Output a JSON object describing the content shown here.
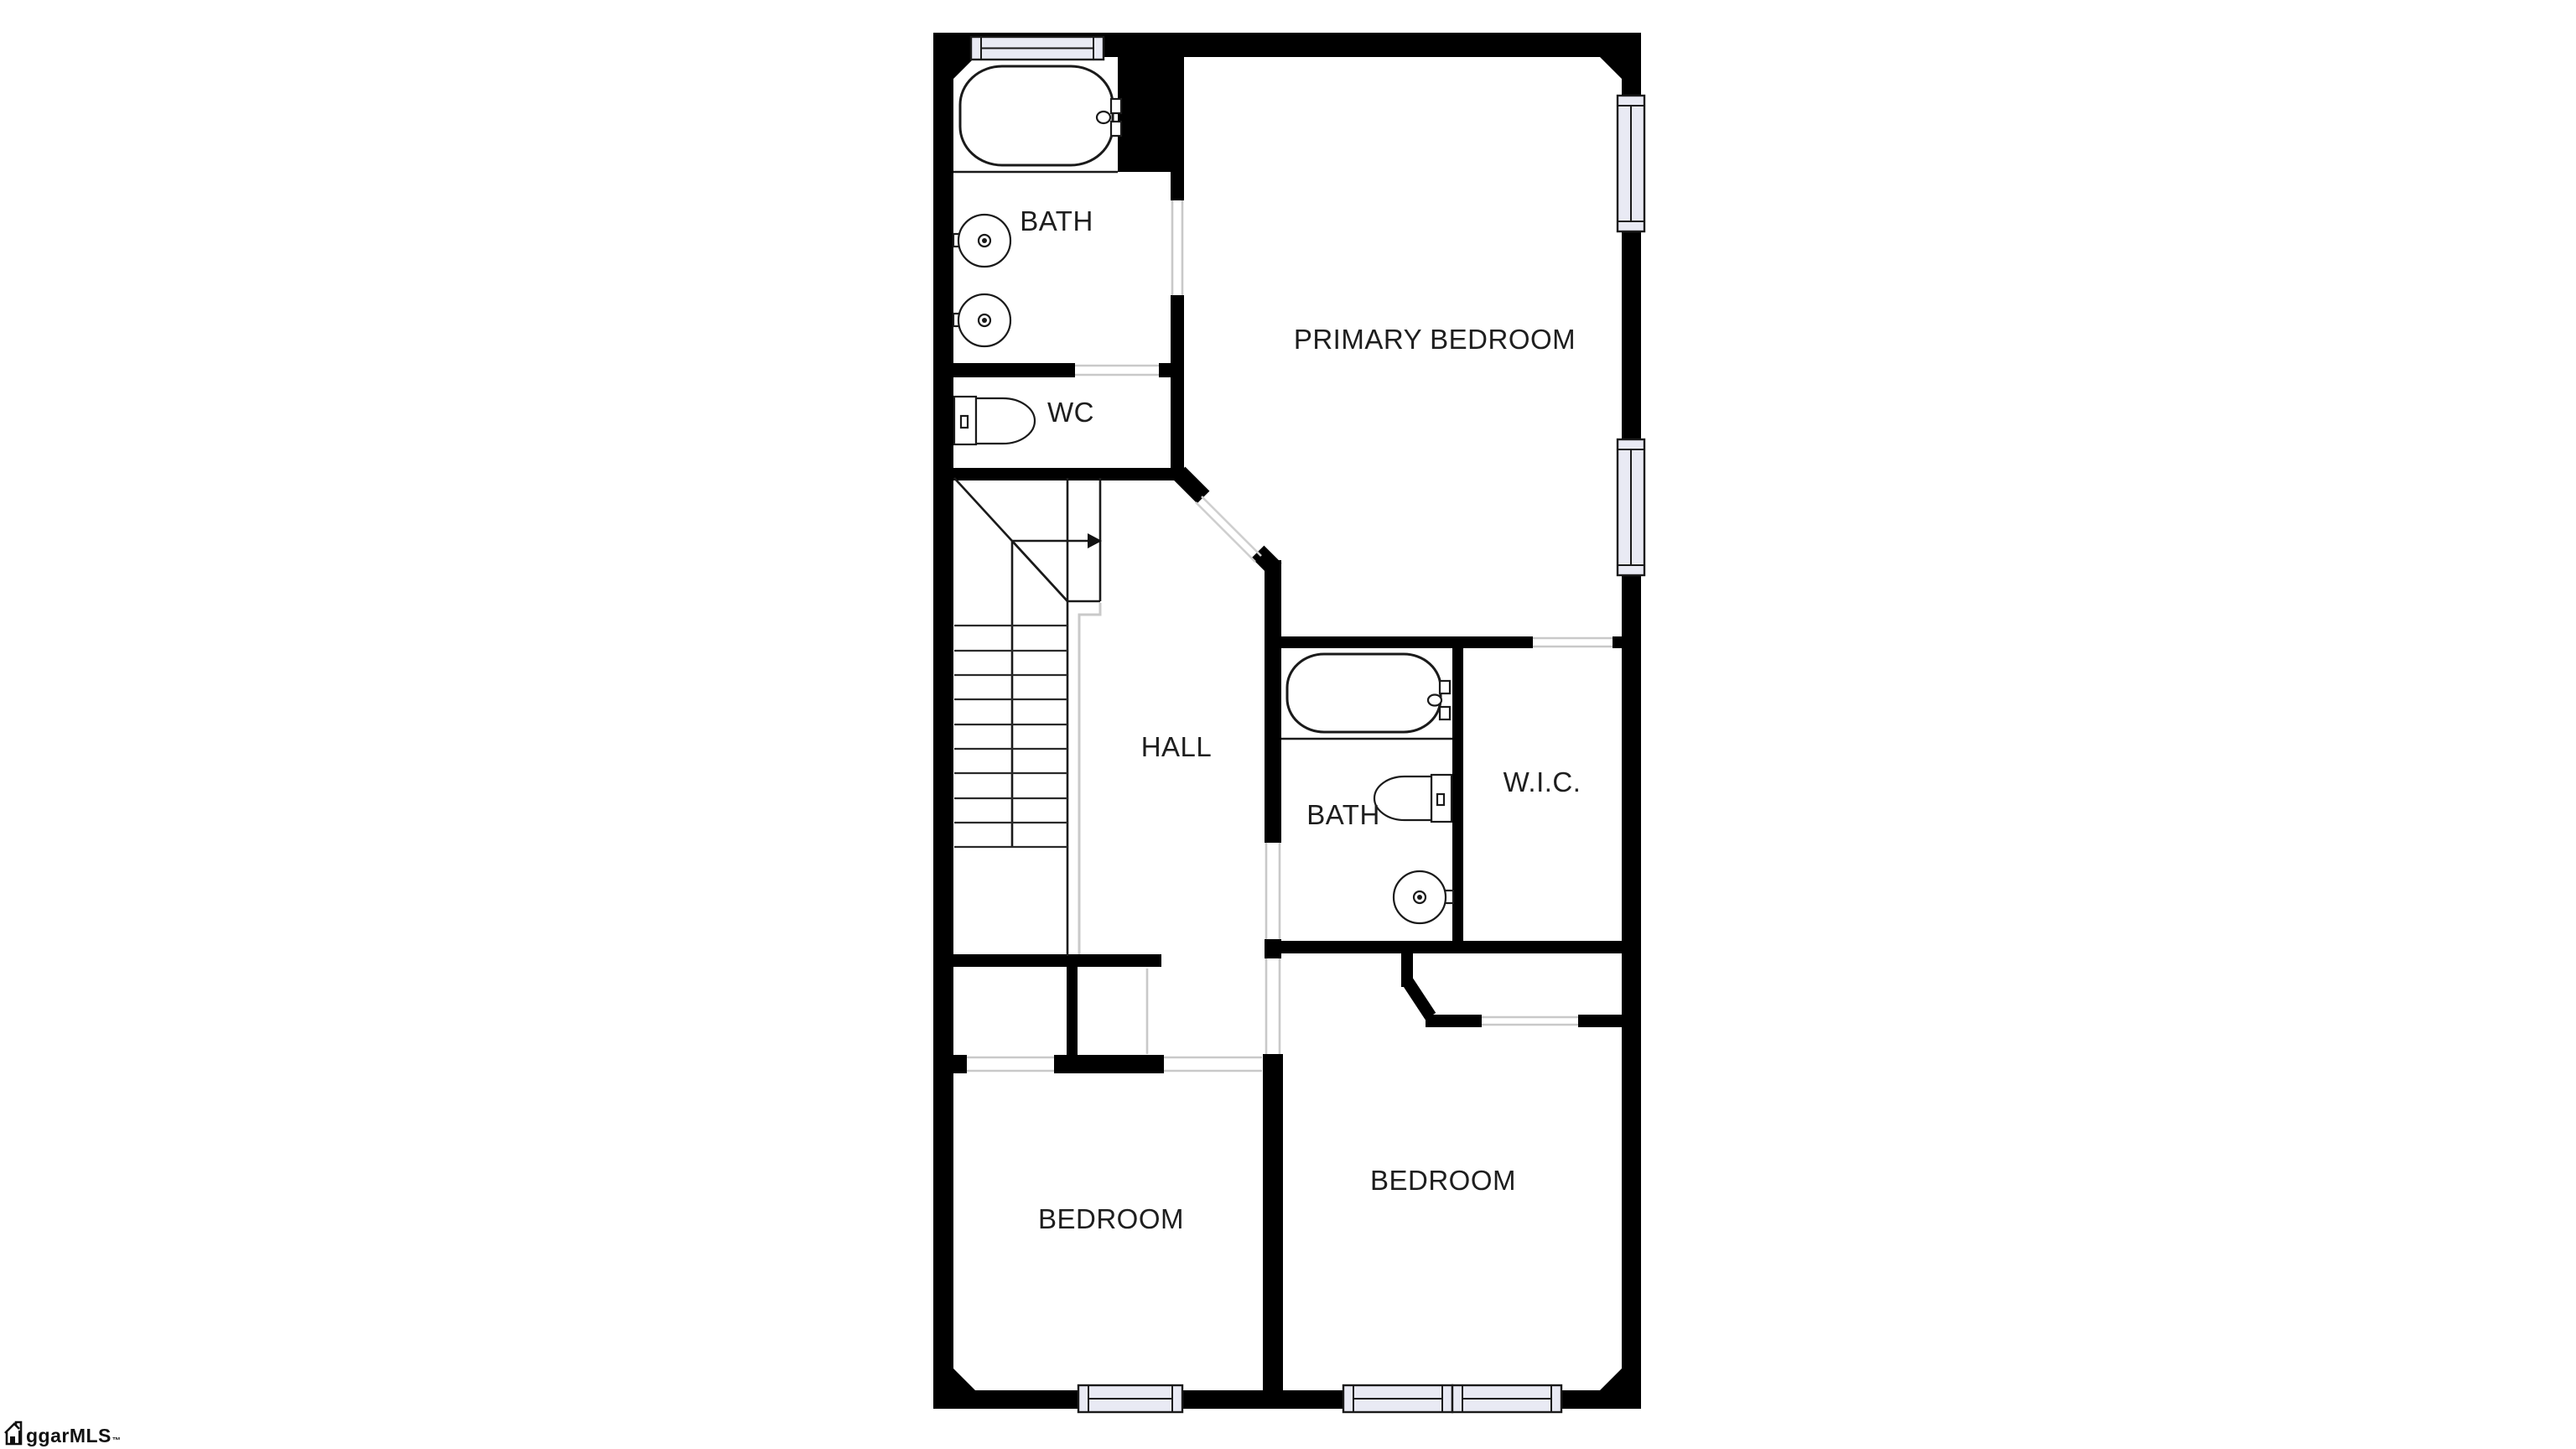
{
  "floorplan": {
    "title": "second-floor-plan",
    "background_color": "#ffffff",
    "wall_color": "#000000",
    "window_fill": "#e9eaf4",
    "railing_color": "#c9c9c9",
    "label_color": "#1e1e1e",
    "rooms": [
      {
        "id": "bath-upper",
        "label": "BATH"
      },
      {
        "id": "wc",
        "label": "WC"
      },
      {
        "id": "primary-bedroom",
        "label": "PRIMARY BEDROOM"
      },
      {
        "id": "hall",
        "label": "HALL"
      },
      {
        "id": "bath-middle",
        "label": "BATH"
      },
      {
        "id": "wic",
        "label": "W.I.C."
      },
      {
        "id": "bedroom-left",
        "label": "BEDROOM"
      },
      {
        "id": "bedroom-right",
        "label": "BEDROOM"
      }
    ],
    "fixtures": [
      "bathtub",
      "vanity-sink",
      "vanity-sink",
      "toilet",
      "bathtub",
      "toilet",
      "pedestal-sink"
    ],
    "windows_count": 6,
    "watermark": {
      "text": "ggarMLS",
      "trademark": "™"
    }
  }
}
